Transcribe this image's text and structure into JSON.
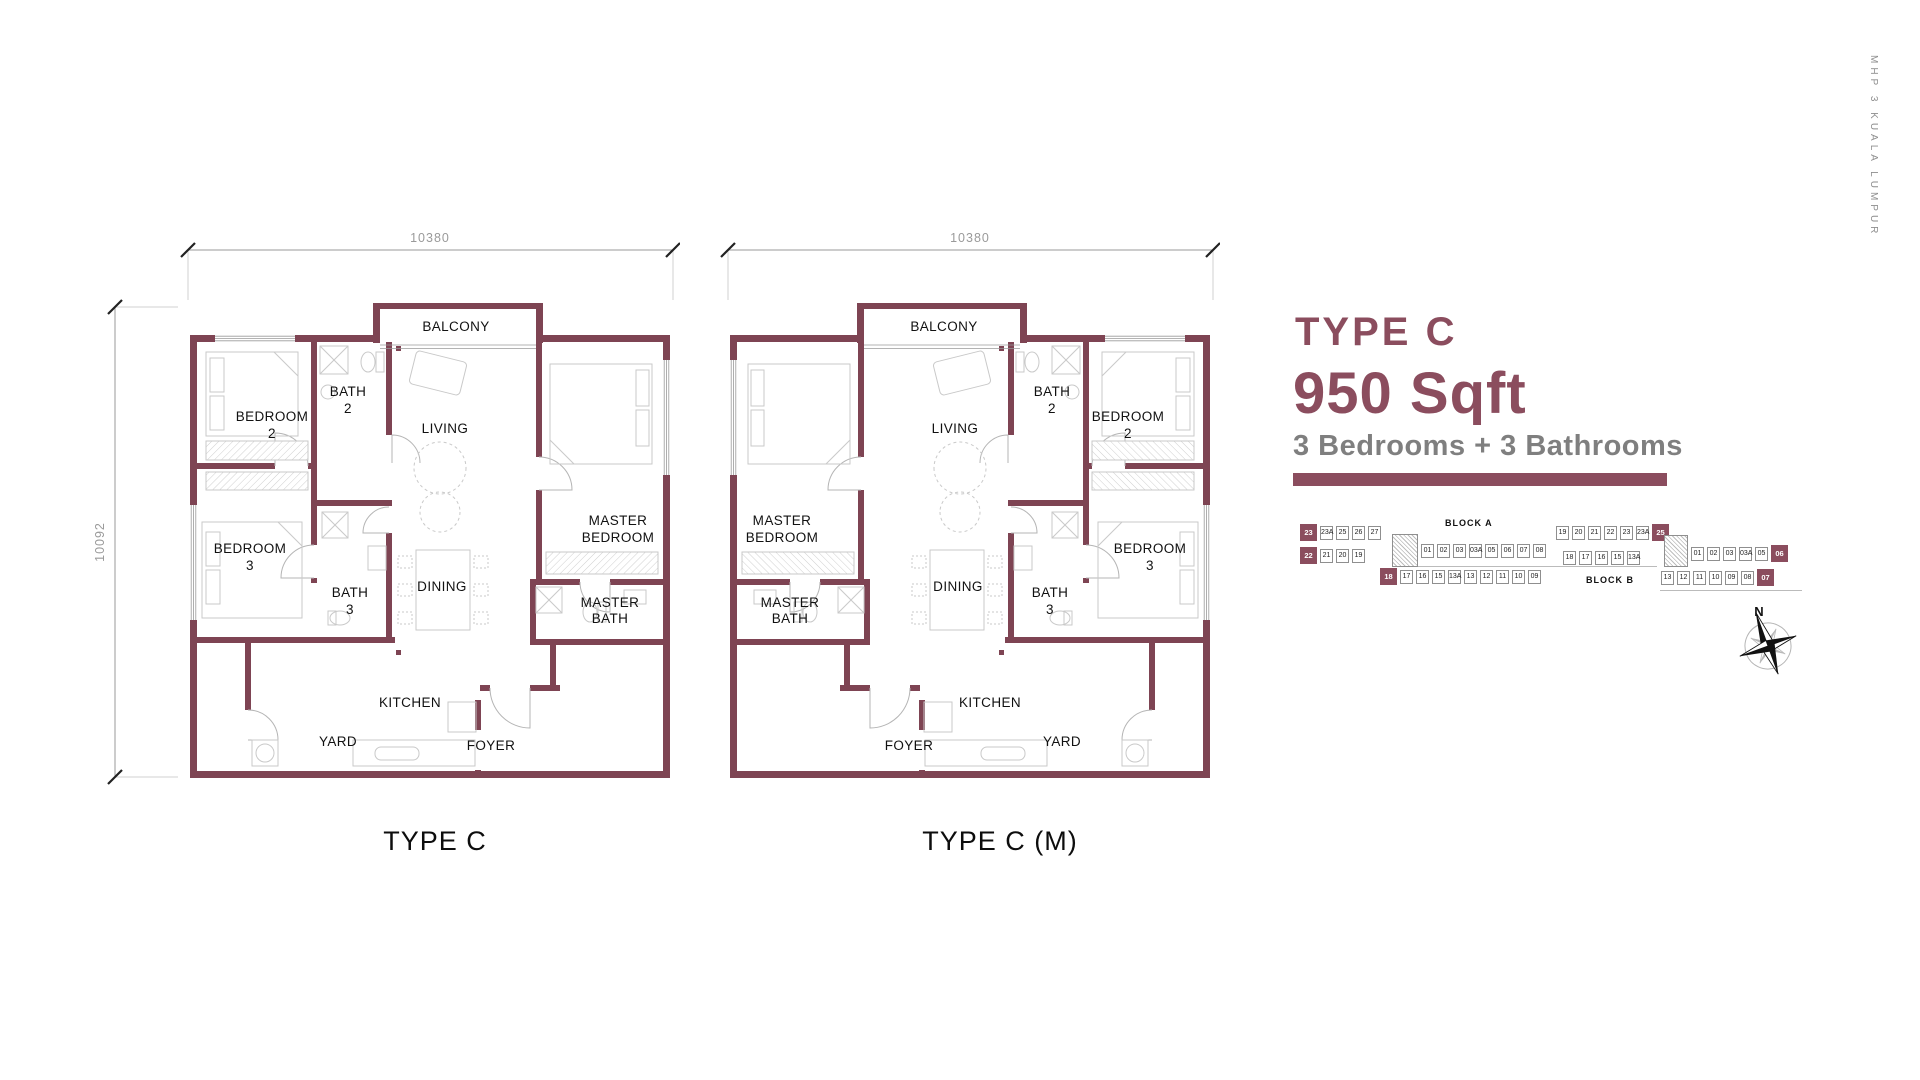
{
  "side_text": "MHP 3 KUALA LUMPUR",
  "info_panel": {
    "type_title": "TYPE C",
    "area": "950 Sqft",
    "config": "3 Bedrooms + 3 Bathrooms"
  },
  "plans": [
    {
      "caption": "TYPE C",
      "dim_top": "10380",
      "dim_left": "10092"
    },
    {
      "caption": "TYPE C (M)",
      "dim_top": "10380"
    }
  ],
  "rooms": {
    "balcony": "BALCONY",
    "living": "LIVING",
    "dining": "DINING",
    "kitchen": "KITCHEN",
    "yard": "YARD",
    "foyer": "FOYER",
    "bedroom2": [
      "BEDROOM",
      "2"
    ],
    "bedroom3": [
      "BEDROOM",
      "3"
    ],
    "bath2": [
      "BATH",
      "2"
    ],
    "bath3": [
      "BATH",
      "3"
    ],
    "master_bedroom": [
      "MASTER",
      "BEDROOM"
    ],
    "master_bath": [
      "MASTER",
      "BATH"
    ]
  },
  "block_diagram": {
    "block_a": {
      "label": "BLOCK A",
      "wing_top_row": [
        "23",
        "23A",
        "25",
        "26",
        "27"
      ],
      "wing_second_row": [
        "22",
        "21",
        "20",
        "19"
      ],
      "mid_row": [
        "01",
        "02",
        "03",
        "03A",
        "05",
        "06",
        "07",
        "08"
      ],
      "bottom_row": [
        "18",
        "17",
        "16",
        "15",
        "13A",
        "13",
        "12",
        "11",
        "10",
        "09"
      ],
      "highlighted": [
        "23",
        "22",
        "18"
      ]
    },
    "block_b": {
      "label": "BLOCK B",
      "top_row": [
        "19",
        "20",
        "21",
        "22",
        "23",
        "23A",
        "25"
      ],
      "second_row": [
        "18",
        "17",
        "16",
        "15",
        "13A"
      ],
      "wing_mid_row": [
        "01",
        "02",
        "03",
        "03A",
        "05",
        "06"
      ],
      "wing_bottom_row": [
        "13",
        "12",
        "11",
        "10",
        "09",
        "08",
        "07"
      ],
      "highlighted": [
        "25",
        "06",
        "07"
      ]
    }
  },
  "compass": {
    "north_label": "N"
  },
  "colors": {
    "maroon": "#8b4d5e",
    "wall": "#7e4453",
    "label_black": "#111111",
    "config_gray": "#7f7f7f",
    "dim_gray": "#9a9a9a",
    "furniture_gray": "#c9c9c9"
  }
}
